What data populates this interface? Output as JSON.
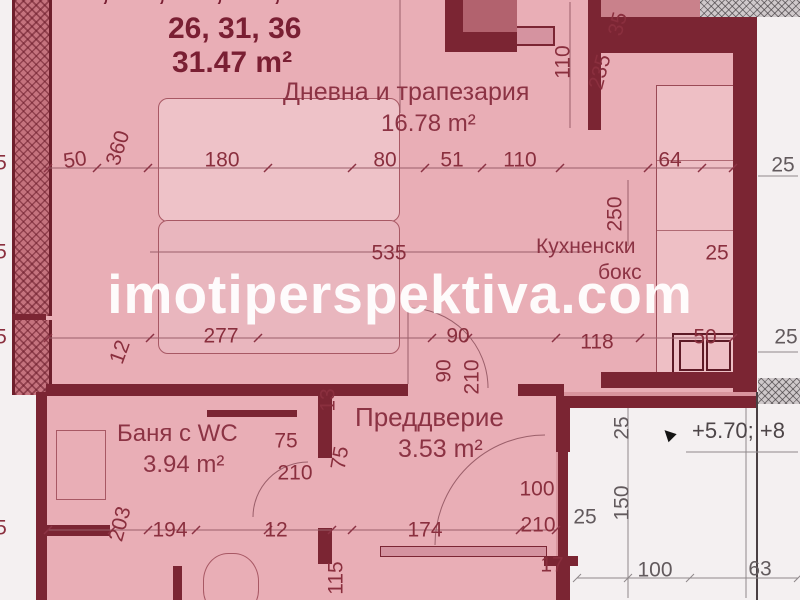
{
  "watermark": "imotiperspektiva.com",
  "header": {
    "clipped_line": "6, 11, 16, 21,",
    "unit_numbers": "26, 31, 36",
    "total_area": "31.47 m²"
  },
  "rooms": {
    "living": {
      "name": "Дневна и трапезария",
      "area": "16.78 m²"
    },
    "kitchen": {
      "name_line1": "Кухненски",
      "name_line2": "бокс"
    },
    "bath": {
      "name": "Баня с WC",
      "area": "3.94 m²"
    },
    "hall": {
      "name": "Преддверие",
      "area": "3.53 m²"
    }
  },
  "level_text": "+5.70; +8",
  "colors": {
    "highlight_pink": "#e9aeb6",
    "background_rose": "#d9959e",
    "wall_maroon": "#7b2533",
    "label_maroon": "#8c3344",
    "outside_gray": "#625a5d",
    "watermark_white": "#ffffff"
  },
  "dims": [
    {
      "t": "50",
      "x": 75,
      "y": 160,
      "r": -8
    },
    {
      "t": "360",
      "x": 118,
      "y": 148,
      "r": -72
    },
    {
      "t": "180",
      "x": 222,
      "y": 160
    },
    {
      "t": "80",
      "x": 385,
      "y": 160
    },
    {
      "t": "51",
      "x": 452,
      "y": 160
    },
    {
      "t": "110",
      "x": 520,
      "y": 160
    },
    {
      "t": "64",
      "x": 670,
      "y": 160
    },
    {
      "t": "110",
      "x": 563,
      "y": 62,
      "r": -90
    },
    {
      "t": "235",
      "x": 600,
      "y": 72,
      "r": -75
    },
    {
      "t": "35",
      "x": 618,
      "y": 24,
      "r": -75
    },
    {
      "t": "250",
      "x": 615,
      "y": 214,
      "r": -90
    },
    {
      "t": "25",
      "x": 717,
      "y": 253
    },
    {
      "t": "535",
      "x": 389,
      "y": 253
    },
    {
      "t": "277",
      "x": 221,
      "y": 336
    },
    {
      "t": "118",
      "x": 597,
      "y": 342
    },
    {
      "t": "50",
      "x": 705,
      "y": 337
    },
    {
      "t": "12",
      "x": 120,
      "y": 352,
      "r": -70
    },
    {
      "t": "90",
      "x": 458,
      "y": 336
    },
    {
      "t": "90",
      "x": 444,
      "y": 371,
      "r": -90
    },
    {
      "t": "210",
      "x": 472,
      "y": 377,
      "r": -90
    },
    {
      "t": "75",
      "x": 286,
      "y": 441
    },
    {
      "t": "210",
      "x": 295,
      "y": 473
    },
    {
      "t": "13",
      "x": 328,
      "y": 400,
      "r": -90
    },
    {
      "t": "75",
      "x": 340,
      "y": 458,
      "r": -80
    },
    {
      "t": "115",
      "x": 336,
      "y": 578,
      "r": -90
    },
    {
      "t": "203",
      "x": 120,
      "y": 524,
      "r": -75
    },
    {
      "t": "194",
      "x": 170,
      "y": 530
    },
    {
      "t": "12",
      "x": 276,
      "y": 530
    },
    {
      "t": "174",
      "x": 425,
      "y": 530
    },
    {
      "t": "100",
      "x": 537,
      "y": 489
    },
    {
      "t": "210",
      "x": 538,
      "y": 525
    },
    {
      "t": "17",
      "x": 552,
      "y": 565
    },
    {
      "t": "5",
      "x": 1,
      "y": 163
    },
    {
      "t": "5",
      "x": 1,
      "y": 252
    },
    {
      "t": "5",
      "x": 1,
      "y": 337
    },
    {
      "t": "5",
      "x": 1,
      "y": 528
    },
    {
      "t": "25",
      "x": 783,
      "y": 165,
      "c": "gray"
    },
    {
      "t": "25",
      "x": 786,
      "y": 337,
      "c": "gray"
    },
    {
      "t": "25",
      "x": 622,
      "y": 428,
      "r": -90,
      "c": "gray"
    },
    {
      "t": "150",
      "x": 622,
      "y": 503,
      "r": -90,
      "c": "gray"
    },
    {
      "t": "25",
      "x": 585,
      "y": 517,
      "c": "gray"
    },
    {
      "t": "100",
      "x": 655,
      "y": 570,
      "c": "gray"
    },
    {
      "t": "63",
      "x": 760,
      "y": 569,
      "c": "gray"
    }
  ]
}
